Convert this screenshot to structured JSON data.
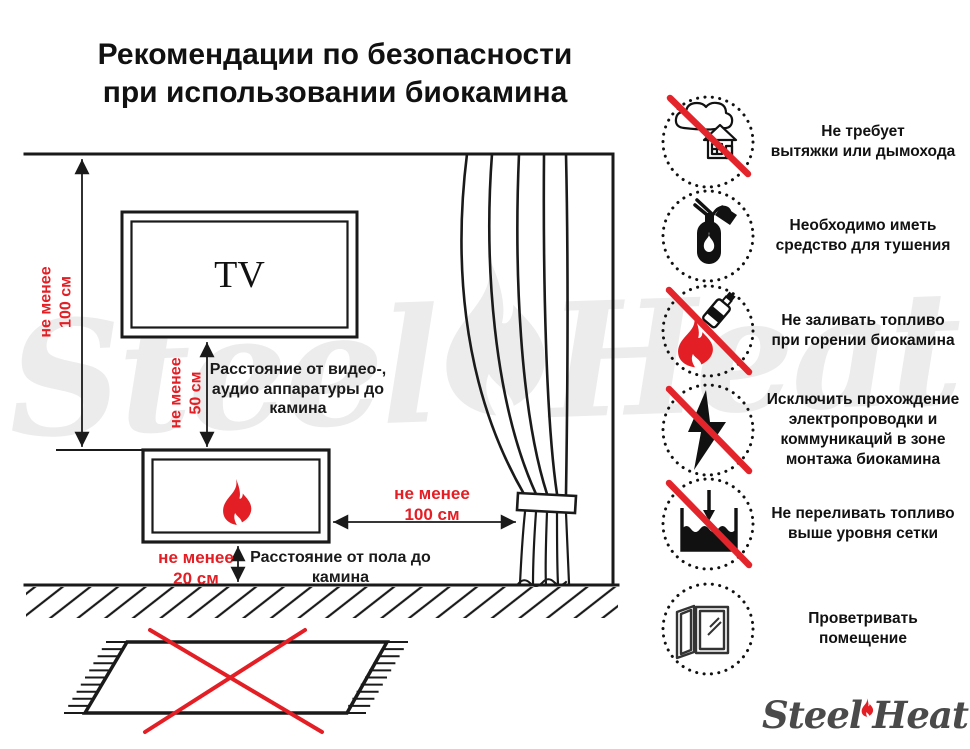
{
  "title": {
    "line1": "Рекомендации по безопасности",
    "line2": "при использовании биокамина"
  },
  "diagram": {
    "tv_label": "TV",
    "dim_height": [
      "не менее",
      "100 см"
    ],
    "dim_tv": [
      "не менее",
      "50 см"
    ],
    "dim_curtain": [
      "не менее",
      "100 см"
    ],
    "dim_floor": [
      "не менее",
      "20 см"
    ],
    "caption_tv": [
      "Расстояние от видео-,",
      "аудио аппаратуры до",
      "камина"
    ],
    "caption_floor": [
      "Расстояние от пола до",
      "камина"
    ]
  },
  "recommendations": [
    {
      "icon": "no-chimney-icon",
      "crossed": true,
      "lines": [
        "Не требует",
        "вытяжки или дымохода"
      ]
    },
    {
      "icon": "extinguisher-icon",
      "crossed": false,
      "lines": [
        "Необходимо иметь",
        "средство для тушения"
      ]
    },
    {
      "icon": "no-refuel-while-burning-icon",
      "crossed": true,
      "lines": [
        "Не заливать топливо",
        "при горении биокамина"
      ]
    },
    {
      "icon": "no-wiring-icon",
      "crossed": true,
      "lines": [
        "Исключить прохождение",
        "электропроводки и",
        "коммуникаций в зоне",
        "монтажа биокамина"
      ]
    },
    {
      "icon": "no-overfill-icon",
      "crossed": true,
      "lines": [
        "Не переливать топливо",
        "выше уровня сетки"
      ]
    },
    {
      "icon": "ventilate-icon",
      "crossed": false,
      "lines": [
        "Проветривать",
        "помещение"
      ]
    }
  ],
  "watermark": {
    "word1": "Steel",
    "word2": "Heat"
  },
  "logo": {
    "word1": "Steel",
    "word2": "Heat"
  },
  "colors": {
    "red": "#e31e24",
    "ink": "#1a1a1a",
    "logo_gray": "#4a4a4a",
    "watermark_gray": "#ececec"
  }
}
